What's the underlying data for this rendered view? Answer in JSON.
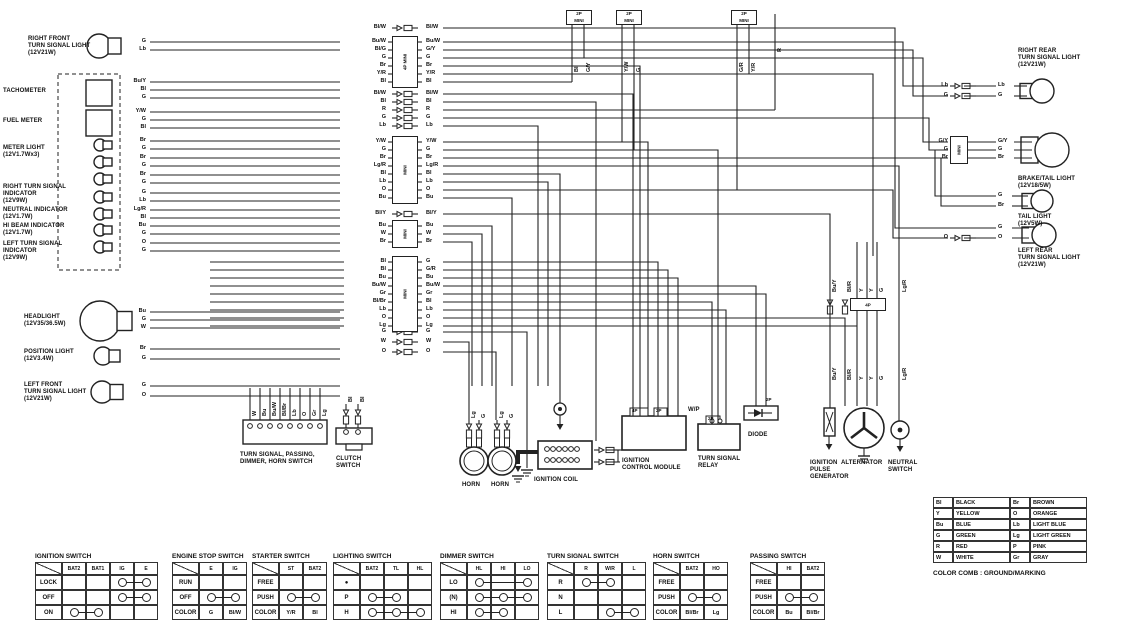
{
  "left_components": [
    {
      "label": "RIGHT FRONT\nTURN SIGNAL LIGHT\n(12V21W)",
      "wires": [
        "G",
        "Lb"
      ]
    },
    {
      "label": "TACHOMETER",
      "wires": [
        "Bu/Y",
        "Bl",
        "G"
      ]
    },
    {
      "label": "FUEL METER",
      "wires": [
        "Y/W",
        "G",
        "Bl"
      ]
    },
    {
      "label": "METER LIGHT\n(12V1.7Wx3)",
      "wires": [
        "Br",
        "G",
        "Br",
        "G",
        "Br",
        "G"
      ]
    },
    {
      "label": "RIGHT TURN SIGNAL\nINDICATOR\n(12V9W)",
      "wires": [
        "G",
        "Lb"
      ]
    },
    {
      "label": "NEUTRAL INDICATOR\n(12V1.7W)",
      "wires": [
        "Lg/R",
        "Bl"
      ]
    },
    {
      "label": "HI BEAM INDICATOR\n(12V1.7W)",
      "wires": [
        "Bu",
        "G"
      ]
    },
    {
      "label": "LEFT TURN SIGNAL\nINDICATOR\n(12V9W)",
      "wires": [
        "O",
        "G"
      ]
    },
    {
      "label": "HEADLIGHT\n(12V35/36.5W)",
      "wires": [
        "Bu",
        "G",
        "W"
      ]
    },
    {
      "label": "POSITION LIGHT\n(12V3.4W)",
      "wires": [
        "Br",
        "G"
      ]
    },
    {
      "label": "LEFT FRONT\nTURN SIGNAL LIGHT\n(12V21W)",
      "wires": [
        "G",
        "O"
      ]
    }
  ],
  "center_connectors": [
    {
      "label": "",
      "rows": [
        [
          "Bl/W",
          "Bl/W"
        ]
      ]
    },
    {
      "label": "4P MINI",
      "rows": [
        [
          "Bu/W",
          "Bu/W"
        ],
        [
          "Bl/G",
          "G/Y"
        ],
        [
          "G",
          "G"
        ],
        [
          "Br",
          "Br"
        ],
        [
          "Y/R",
          "Y/R"
        ],
        [
          "Bl",
          "Bl"
        ]
      ]
    },
    {
      "label": "",
      "rows": [
        [
          "Bl/W",
          "Bl/W"
        ],
        [
          "Bl",
          "Bl"
        ],
        [
          "R",
          "R"
        ],
        [
          "G",
          "G"
        ],
        [
          "Lb",
          "Lb"
        ]
      ]
    },
    {
      "label": "MINI",
      "rows": [
        [
          "Y/W",
          "Y/W"
        ],
        [
          "G",
          "G"
        ],
        [
          "Br",
          "Br"
        ],
        [
          "Lg/R",
          "Lg/R"
        ],
        [
          "Bl",
          "Bl"
        ],
        [
          "Lb",
          "Lb"
        ],
        [
          "O",
          "O"
        ],
        [
          "Bu",
          "Bu"
        ]
      ]
    },
    {
      "label": "",
      "rows": [
        [
          "Bl/Y",
          "Bl/Y"
        ]
      ]
    },
    {
      "label": "MINI",
      "rows": [
        [
          "Bu",
          "Bu"
        ],
        [
          "W",
          "W"
        ],
        [
          "Br",
          "Br"
        ]
      ]
    },
    {
      "label": "MINI",
      "rows": [
        [
          "Bl",
          "G"
        ],
        [
          "Bl",
          "G/R"
        ],
        [
          "Bu",
          "Bu"
        ],
        [
          "Bu/W",
          "Bu/W"
        ],
        [
          "Gr",
          "Gr"
        ],
        [
          "Bl/Br",
          "Bl"
        ],
        [
          "Lb",
          "Lb"
        ],
        [
          "O",
          "O"
        ],
        [
          "Lg",
          "Lg"
        ]
      ]
    },
    {
      "label": "",
      "rows": [
        [
          "G",
          "G"
        ],
        [
          "W",
          "W"
        ],
        [
          "O",
          "O"
        ]
      ]
    }
  ],
  "top_connectors": [
    {
      "label": "2P",
      "sub": "MINI",
      "wires": [
        "Bl",
        "G/Y"
      ]
    },
    {
      "label": "2P",
      "sub": "MINI",
      "wires": [
        "Y/W",
        "G"
      ]
    },
    {
      "label": "2P",
      "sub": "MINI",
      "wires": [
        "G/R",
        "Y/R"
      ]
    }
  ],
  "stray_wire_label": "R",
  "right_components": [
    {
      "label": "RIGHT REAR\nTURN SIGNAL LIGHT\n(12V21W)",
      "wl": [
        "Lb",
        "G"
      ],
      "wr": [
        "Lb",
        "G"
      ]
    },
    {
      "label": "BRAKE/TAIL LIGHT\n(12V18/5W)",
      "wl": [
        "G/Y",
        "G",
        "Br"
      ],
      "wr": [
        "G/Y",
        "G",
        "Br"
      ],
      "conn": "MINI"
    },
    {
      "label": "TAIL LIGHT\n(12V5W)",
      "wl": [],
      "wr": [
        "G",
        "Br"
      ]
    },
    {
      "label": "LEFT REAR\nTURN SIGNAL LIGHT\n(12V21W)",
      "wl": [
        "O"
      ],
      "wr": [
        "G",
        "O"
      ]
    }
  ],
  "bottom_components": {
    "switch_box": "TURN SIGNAL, PASSING,\nDIMMER, HORN SWITCH",
    "switch_box_wires": [
      "W",
      "Bu",
      "Bu/W",
      "Bl/Br",
      "Lb",
      "O",
      "Gr",
      "Lg"
    ],
    "clutch": "CLUTCH\nSWITCH",
    "clutch_wires": [
      "Bl",
      "Bl"
    ],
    "horn1": "HORN",
    "horn2": "HORN",
    "horn_wires": [
      "Lg",
      "G",
      "Lg",
      "G"
    ],
    "ignition_coil": "IGNITION COIL",
    "icm": "IGNITION\nCONTROL MODULE",
    "icm_tabs": [
      "4P",
      "2P"
    ],
    "icm_side": "W/P",
    "relay": "TURN SIGNAL\nRELAY",
    "relay_tab": "2P",
    "diode": "DIODE",
    "diode_tab": "2P",
    "ipg": "IGNITION\nPULSE\nGENERATOR",
    "alternator": "ALTERNATOR",
    "neutral": "NEUTRAL\nSWITCH",
    "harness_conn": "4P",
    "harness_wires_top": [
      "Bu/Y",
      "Bl/R",
      "Y",
      "Y",
      "G",
      "Lg/R"
    ],
    "harness_wires_bottom": [
      "Bu/Y",
      "Bl/R",
      "Y",
      "Y",
      "G",
      "Lg/R"
    ]
  },
  "switch_tables": [
    {
      "title": "IGNITION SWITCH",
      "cols": [
        "BAT2",
        "BAT1",
        "IG",
        "E"
      ],
      "rows": [
        {
          "l": "LOCK",
          "c": [
            "",
            "",
            "O-",
            "-O"
          ]
        },
        {
          "l": "OFF",
          "c": [
            "",
            "",
            "O-",
            "-O"
          ]
        },
        {
          "l": "ON",
          "c": [
            "O-",
            "-O",
            "",
            ""
          ]
        }
      ]
    },
    {
      "title": "ENGINE STOP SWITCH",
      "cols": [
        "E",
        "IG"
      ],
      "rows": [
        {
          "l": "RUN",
          "c": [
            "",
            ""
          ]
        },
        {
          "l": "OFF",
          "c": [
            "O-",
            "-O"
          ]
        },
        {
          "l": "COLOR",
          "c": [
            "G",
            "Bl/W"
          ]
        }
      ]
    },
    {
      "title": "STARTER SWITCH",
      "cols": [
        "ST",
        "BAT2"
      ],
      "rows": [
        {
          "l": "FREE",
          "c": [
            "",
            ""
          ]
        },
        {
          "l": "PUSH",
          "c": [
            "O-",
            "-O"
          ]
        },
        {
          "l": "COLOR",
          "c": [
            "Y/R",
            "Bl"
          ]
        }
      ]
    },
    {
      "title": "LIGHTING SWITCH",
      "cols": [
        "BAT2",
        "TL",
        "HL"
      ],
      "rows": [
        {
          "l": "●",
          "c": [
            "",
            "",
            ""
          ]
        },
        {
          "l": "P",
          "c": [
            "O-",
            "-O",
            ""
          ]
        },
        {
          "l": "H",
          "c": [
            "O-",
            "-O-",
            "-O"
          ]
        }
      ]
    },
    {
      "title": "DIMMER SWITCH",
      "cols": [
        "HL",
        "HI",
        "LO"
      ],
      "rows": [
        {
          "l": "LO",
          "c": [
            "O-",
            "=",
            "-O"
          ]
        },
        {
          "l": "(N)",
          "c": [
            "O-",
            "-O-",
            "-O"
          ]
        },
        {
          "l": "HI",
          "c": [
            "O-",
            "-O",
            ""
          ]
        }
      ]
    },
    {
      "title": "TURN SIGNAL SWITCH",
      "cols": [
        "R",
        "W/R",
        "L"
      ],
      "rows": [
        {
          "l": "R",
          "c": [
            "O-",
            "-O",
            ""
          ]
        },
        {
          "l": "N",
          "c": [
            "",
            "",
            ""
          ]
        },
        {
          "l": "L",
          "c": [
            "",
            "O-",
            "-O"
          ]
        }
      ]
    },
    {
      "title": "HORN SWITCH",
      "cols": [
        "BAT2",
        "HO"
      ],
      "rows": [
        {
          "l": "FREE",
          "c": [
            "",
            ""
          ]
        },
        {
          "l": "PUSH",
          "c": [
            "O-",
            "-O"
          ]
        },
        {
          "l": "COLOR",
          "c": [
            "Bl/Br",
            "Lg"
          ]
        }
      ]
    },
    {
      "title": "PASSING SWITCH",
      "cols": [
        "HI",
        "BAT2"
      ],
      "rows": [
        {
          "l": "FREE",
          "c": [
            "",
            ""
          ]
        },
        {
          "l": "PUSH",
          "c": [
            "O-",
            "-O"
          ]
        },
        {
          "l": "COLOR",
          "c": [
            "Bu",
            "Bl/Br"
          ]
        }
      ]
    }
  ],
  "color_table": {
    "rows": [
      [
        "Bl",
        "BLACK",
        "Br",
        "BROWN"
      ],
      [
        "Y",
        "YELLOW",
        "O",
        "ORANGE"
      ],
      [
        "Bu",
        "BLUE",
        "Lb",
        "LIGHT BLUE"
      ],
      [
        "G",
        "GREEN",
        "Lg",
        "LIGHT GREEN"
      ],
      [
        "R",
        "RED",
        "P",
        "PINK"
      ],
      [
        "W",
        "WHITE",
        "Gr",
        "GRAY"
      ]
    ],
    "caption": "COLOR COMB : GROUND/MARKING"
  }
}
